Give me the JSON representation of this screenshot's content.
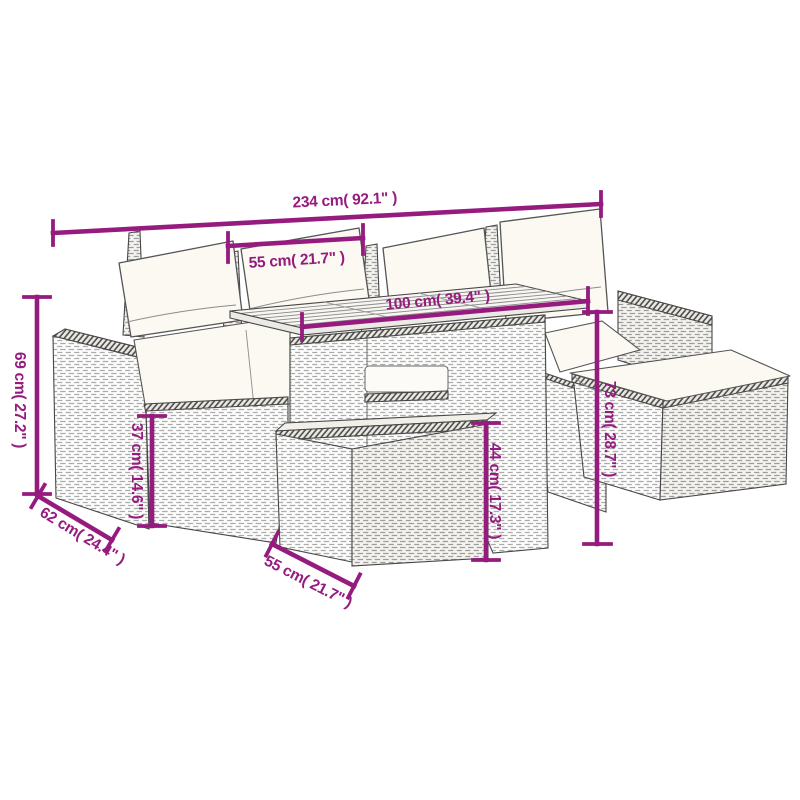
{
  "diagram": {
    "type": "product-dimension-diagram",
    "subject": "garden rattan sofa set with table, footstool and ottoman",
    "accent_color": "#951B7F",
    "outline_color": "#474747",
    "cushion_color": "#FBF9F2",
    "background_color": "#FFFFFF"
  },
  "dimensions": {
    "overall_width": "234 cm( 92.1\" )",
    "table_width_top": "55 cm( 21.7\" )",
    "table_length": "100 cm( 39.4\" )",
    "sofa_height": "69 cm( 27.2\" )",
    "seat_height": "37 cm( 14.6\" )",
    "sofa_depth": "62 cm( 24.4\" )",
    "footstool_height": "44 cm( 17.3\" )",
    "table_height": "73 cm( 28.7\" )",
    "footstool_width": "55 cm( 21.7\" )"
  }
}
